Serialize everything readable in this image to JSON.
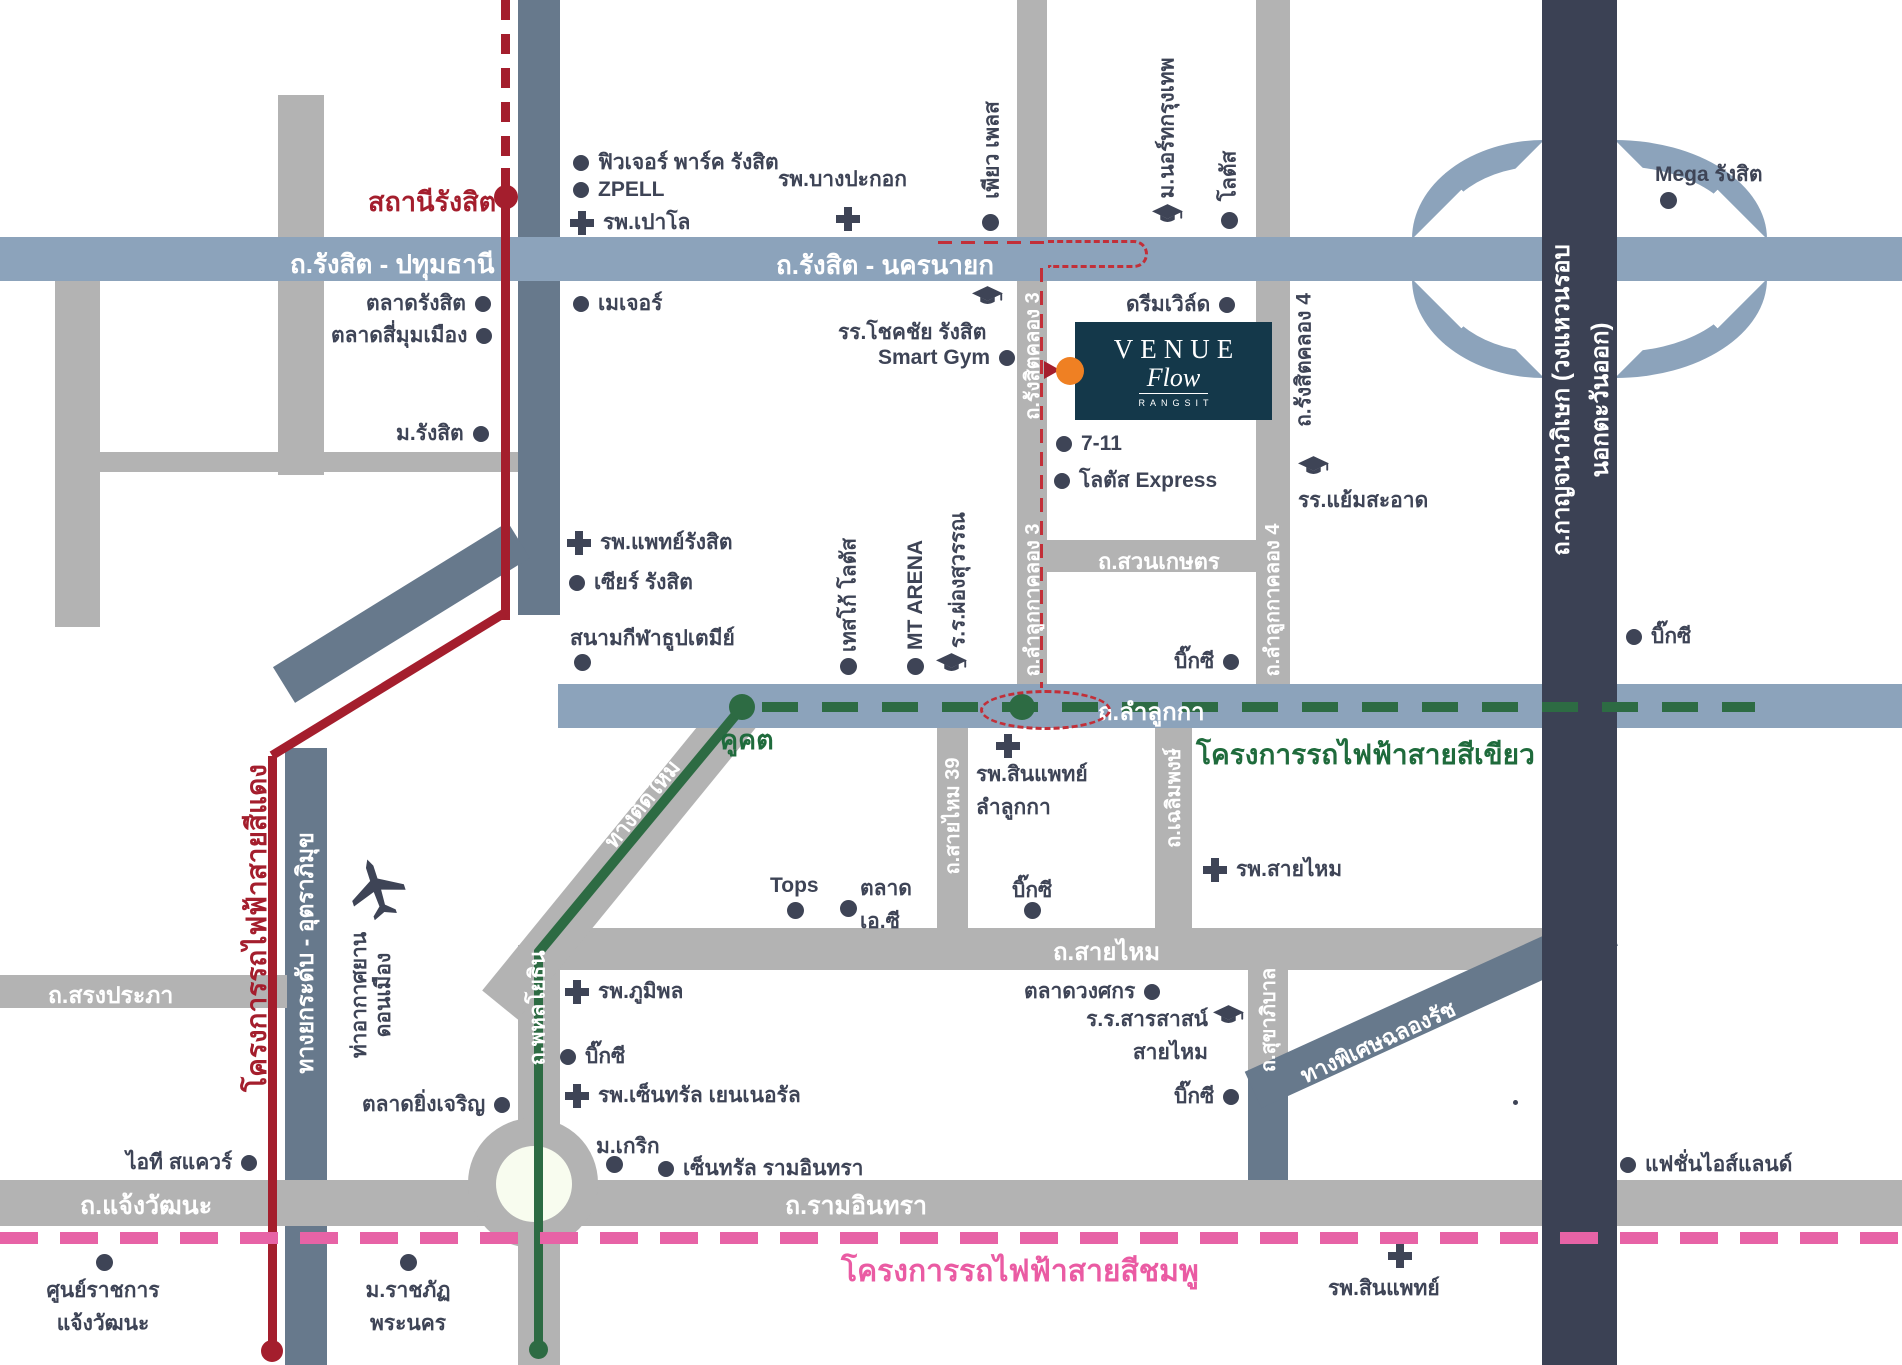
{
  "project": {
    "name": "VENUE",
    "script": "Flow",
    "subtitle": "RANGSIT"
  },
  "colors": {
    "road_gray": "#b3b3b3",
    "road_blue": "#8ca3bb",
    "road_slate": "#67798c",
    "expressway_dark": "#3b4154",
    "red_line": "#a41e2d",
    "green_line": "#2d6b43",
    "pink_line": "#e763a6",
    "route_dash": "#c22f38",
    "text_dark": "#3e4456",
    "project_teal": "#14384a",
    "project_orange": "#ef8023"
  },
  "roads": {
    "rangsit_pathumthani": "ถ.รังสิต - ปทุมธานี",
    "rangsit_nakhonnayok": "ถ.รังสิต - นครนายก",
    "rangsit_khlong3": "ถ.รังสิตคลอง 3",
    "rangsit_khlong4": "ถ.รังสิตคลอง 4",
    "suan_kaset": "ถ.สวนเกษตร",
    "lamlukka_khlong3": "ถ.ลำลูกกาคลอง 3",
    "lamlukka_khlong4": "ถ.ลำลูกกาคลอง 4",
    "lamlukka": "ถ.ลำลูกกา",
    "saimai39": "ถ.สายไหม 39",
    "chalermpong": "ถ.เฉลิมพงษ์",
    "saimai": "ถ.สายไหม",
    "sukhaphiban": "ถ.สุขาภิบาล",
    "song_prapha": "ถ.สรงประภา",
    "phahonyothin": "ถ.พหลโยธิน",
    "chaengwattana": "ถ.แจ้งวัฒนะ",
    "ramindra": "ถ.รามอินทรา",
    "tang_tad_mai": "ทางตัดใหม่",
    "tollway": "ทางยกระดับ - อุตราภิมุข",
    "chalong_rat": "ทางพิเศษฉลองรัช",
    "kanchanaphisek": "ถ.กาญจนาภิเษก (วงแหวนรอบนอกตะวันออก)"
  },
  "transit": {
    "red_line": "โครงการรถไฟฟ้าสายสีแดง",
    "green_line": "โครงการรถไฟฟ้าสายสีเขียว",
    "pink_line": "โครงการรถไฟฟ้าสายสีชมพู",
    "rangsit_station": "สถานีรังสิต",
    "khukhot_station": "คูคต"
  },
  "pois": {
    "future_park": "ฟิวเจอร์ พาร์ค รังสิต",
    "zpell": "ZPELL",
    "paolo": "รพ.เปาโล",
    "bangpakok": "รพ.บางปะกอก",
    "pure_place": "เพียว เพลส",
    "north_bkk_u": "ม.นอร์ทกรุงเทพ",
    "lotus_top": "โลตัส",
    "mega": "Mega รังสิต",
    "talad_rangsit": "ตลาดรังสิต",
    "talad_simummuang": "ตลาดสี่มุมเมือง",
    "major": "เมเจอร์",
    "rangsit_u": "ม.รังสิต",
    "dream_world": "ดรีมเวิล์ด",
    "chokchai": "รร.โชคชัย รังสิต",
    "smart_gym": "Smart Gym",
    "seven11": "7-11",
    "lotus_express": "โลตัส Express",
    "yaem_saard": "รร.แย้มสะอาด",
    "paet_rangsit": "รพ.แพทย์รังสิต",
    "zeer_rangsit": "เซียร์ รังสิต",
    "stadium": "สนามกีฬาธูปเตมีย์",
    "tesco_lotus": "เทสโก้ โลตัส",
    "mt_arena": "MT ARENA",
    "phongsuwan": "ร.ร.ผ่องสุวรรณ",
    "bigc_khlong4": "บิ๊กซี",
    "bigc_ring": "บิ๊กซี",
    "sinphaet_lamlukka": "รพ.สินแพทย์\nลำลูกกา",
    "tops": "Tops",
    "talad_ac": "ตลาด\nเอ.ซี",
    "bigc_saimai": "บิ๊กซี",
    "saimai_hospital": "รพ.สายไหม",
    "talad_wongsakorn": "ตลาดวงศกร",
    "sarasas": "ร.ร.สารสาสน์\nสายไหม",
    "bigc_sukhaphiban": "บิ๊กซี",
    "donmueang_airport": "ท่าอากาศยาน\nดอนเมือง",
    "bhumibol": "รพ.ภูมิพล",
    "bigc_phahon": "บิ๊กซี",
    "central_general": "รพ.เซ็นทรัล เยนเนอรัล",
    "yingcharoen": "ตลาดยิ่งเจริญ",
    "krirk_u": "ม.เกริก",
    "central_ramindra": "เซ็นทรัล รามอินทรา",
    "it_square": "ไอที สแควร์",
    "gov_complex": "ศูนย์ราชการ\nแจ้งวัฒนะ",
    "rajabhat": "ม.ราชภัฏ\nพระนคร",
    "synphaet": "รพ.สินแพทย์",
    "fashion_island": "แฟชั่นไอส์แลนด์"
  }
}
